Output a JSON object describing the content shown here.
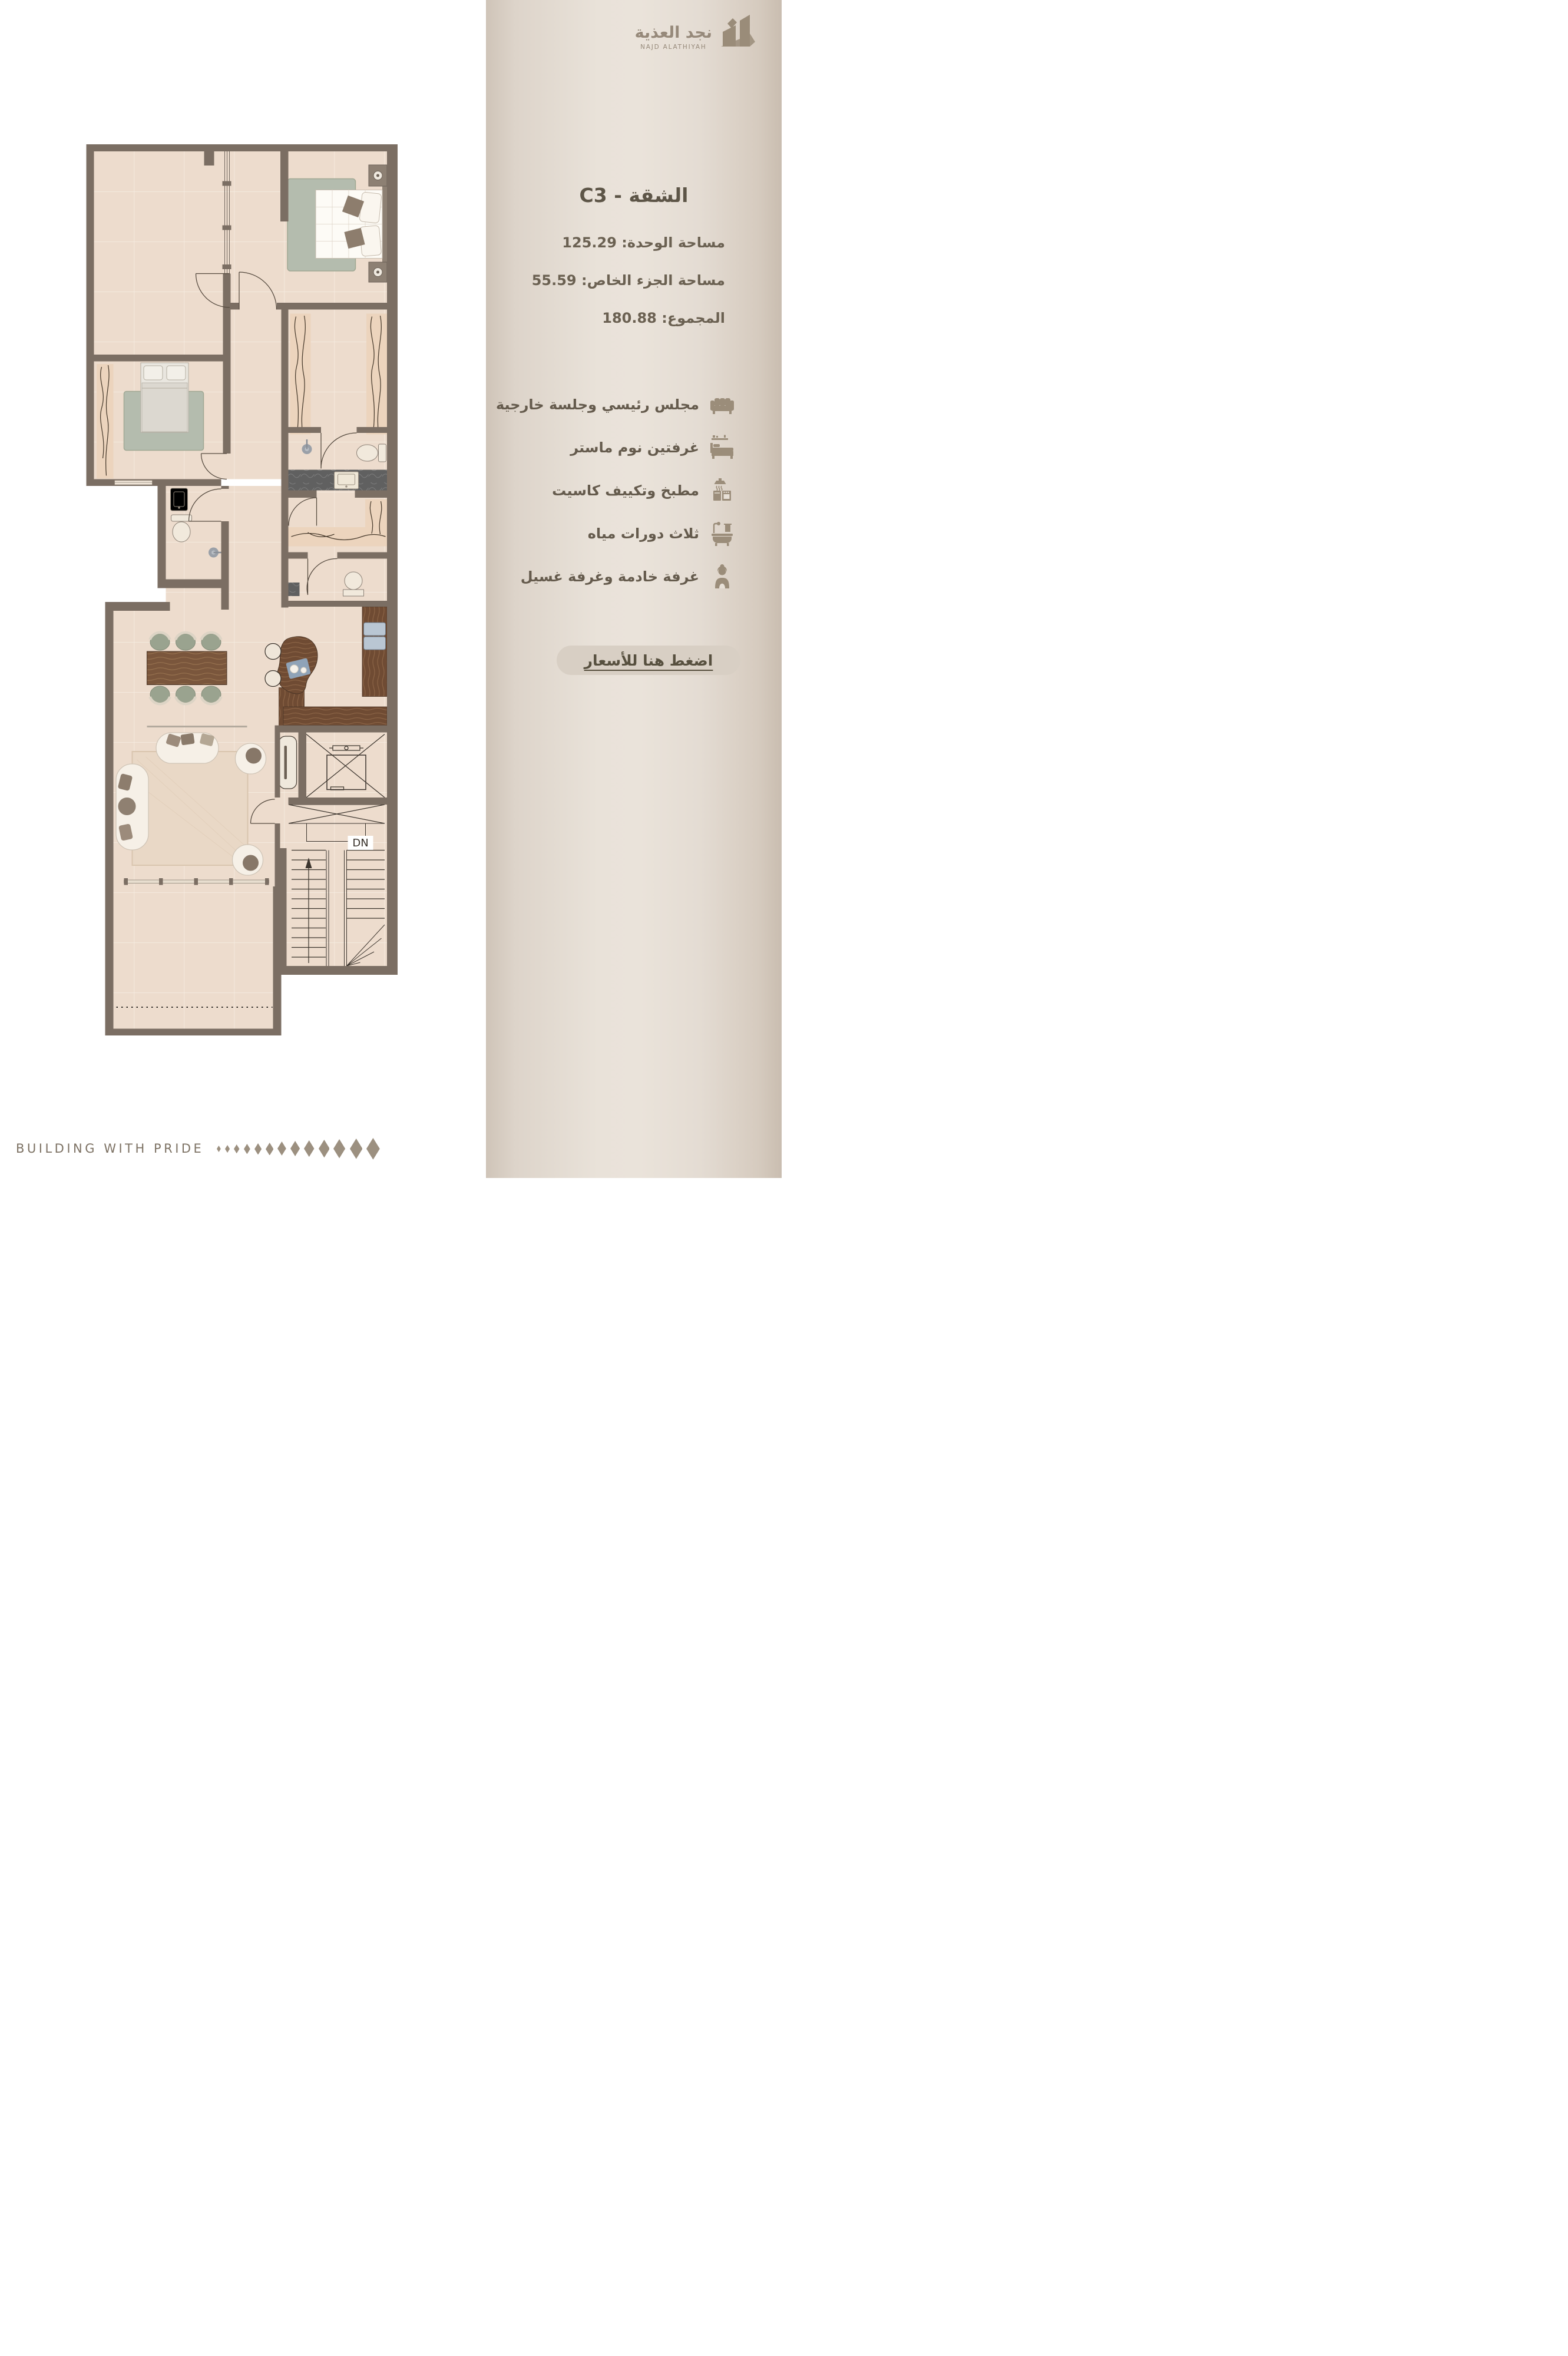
{
  "logo": {
    "arabic": "نجد العذية",
    "english": "NAJD ALATHIYAH"
  },
  "unit": {
    "title": "الشقة - C3",
    "area_lines": [
      "مساحة الوحدة: 125.29",
      "مساحة الجزء الخاص: 55.59",
      "المجموع: 180.88"
    ]
  },
  "features": [
    {
      "icon": "sofa-icon",
      "text": "مجلس رئيسي وجلسة خارجية"
    },
    {
      "icon": "bed-icon",
      "text": "غرفتين نوم ماستر"
    },
    {
      "icon": "kitchen-icon",
      "text": "مطبخ وتكييف كاسيت"
    },
    {
      "icon": "bath-icon",
      "text": "ثلاث دورات مياه"
    },
    {
      "icon": "maid-icon",
      "text": "غرفة خادمة وغرفة غسيل"
    }
  ],
  "cta": {
    "label": "اضغط هنا للأسعار"
  },
  "floor_plan": {
    "down_label": "DN"
  },
  "footer": {
    "text": "BUILDING WITH PRIDE",
    "diamond_count": 13,
    "diamond_color": "#9c9080"
  },
  "colors": {
    "panel": "#e9e2d9",
    "wall": "#7b6e63",
    "accent": "#9b8d7a",
    "text": "#6b6152"
  }
}
